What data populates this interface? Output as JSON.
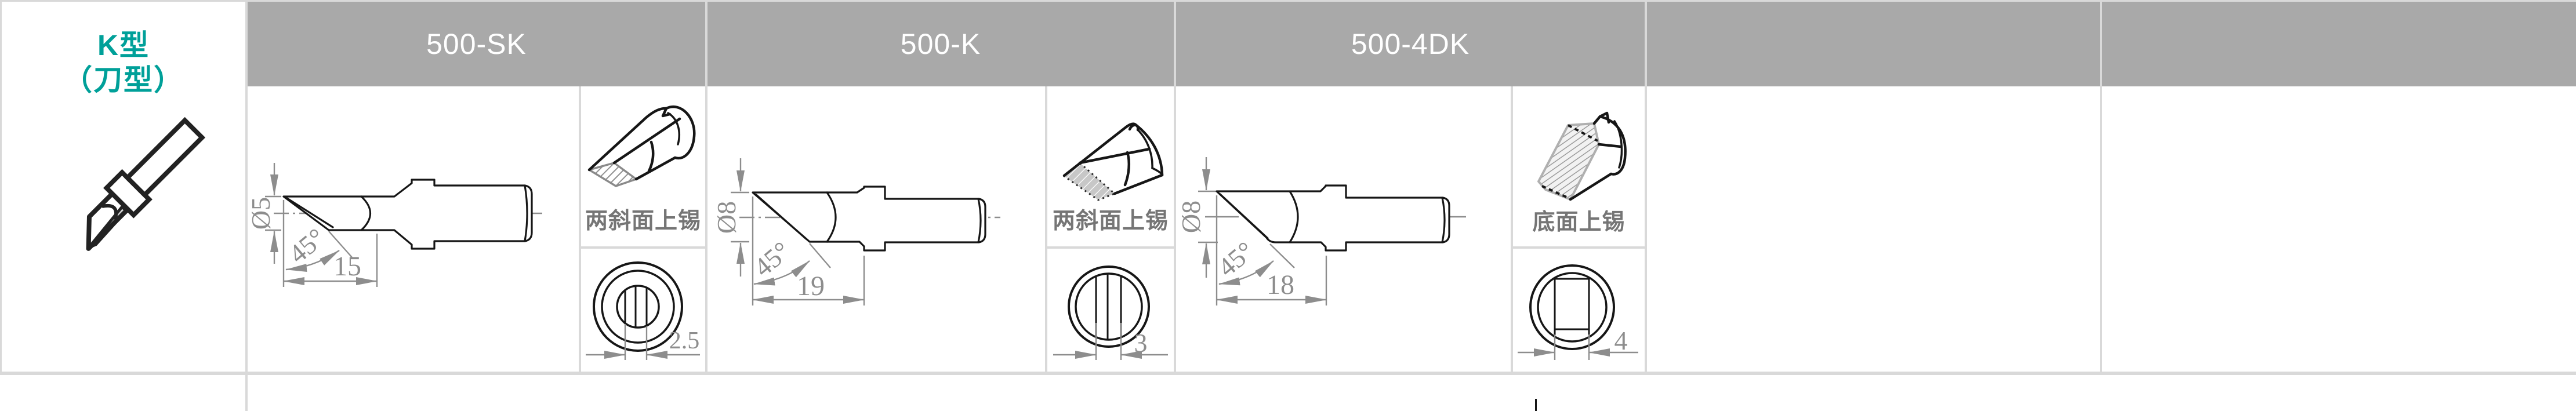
{
  "style": {
    "header_bg": "#a9a9a9",
    "header_text": "#ffffff",
    "grid_color": "#d9d9d9",
    "accent_teal": "#00a099",
    "drawing_ink": "#161616",
    "dimension_gray": "#8d8d8d",
    "label_gray": "#757575"
  },
  "row_header": {
    "line1": "K型",
    "line2": "（刀型）"
  },
  "headers": [
    "500-SK",
    "500-K",
    "500-4DK",
    "",
    ""
  ],
  "columns": [
    {
      "model": "500-SK",
      "side_view": {
        "diameter": "Ø5",
        "angle": "45°",
        "tip_length": "15"
      },
      "tinning_note": "两斜面上锡",
      "end_view": {
        "flat_width": "2.5"
      }
    },
    {
      "model": "500-K",
      "side_view": {
        "diameter": "Ø8",
        "angle": "45°",
        "tip_length": "19"
      },
      "tinning_note": "两斜面上锡",
      "end_view": {
        "flat_width": "3"
      }
    },
    {
      "model": "500-4DK",
      "side_view": {
        "diameter": "Ø8",
        "angle": "45°",
        "tip_length": "18"
      },
      "tinning_note": "底面上锡",
      "end_view": {
        "flat_width": "4"
      }
    }
  ]
}
